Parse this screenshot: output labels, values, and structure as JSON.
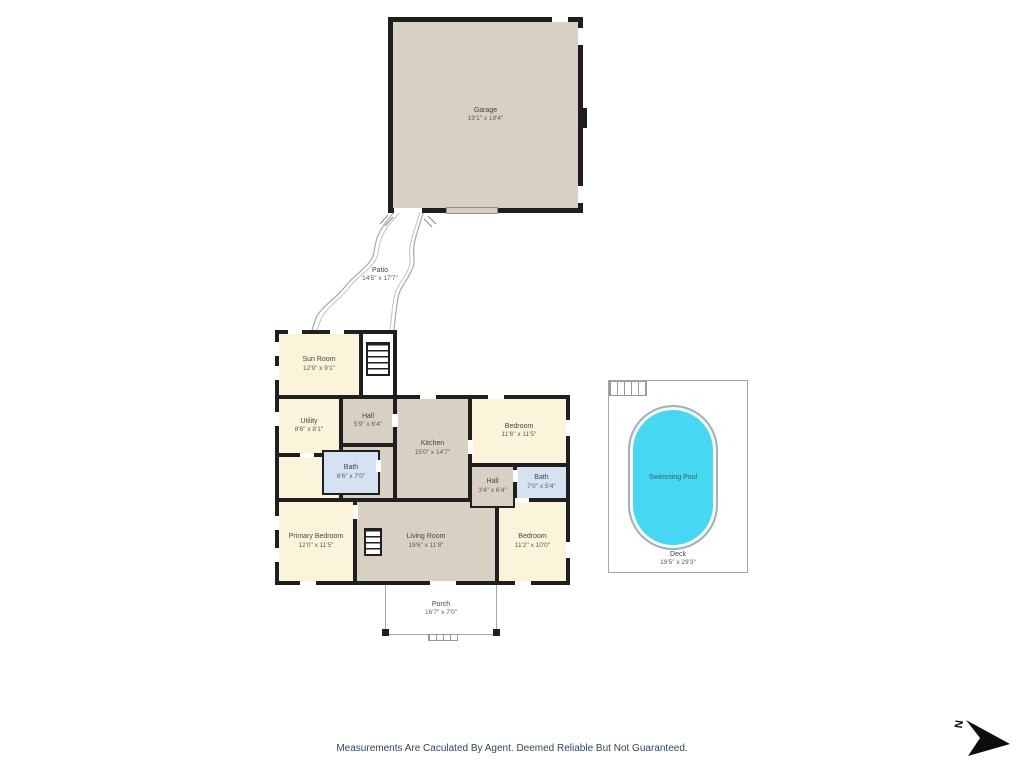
{
  "page": {
    "footer_disclaimer": "Measurements Are Caculated By Agent. Deemed Reliable But Not Guaranteed.",
    "compass_label": "N"
  },
  "colors": {
    "wall": "#1f1f1f",
    "room_tan": "#d8d0c2",
    "room_cream": "#fbf4db",
    "bath_blue": "#d4e2f2",
    "pool_water": "#46d7f2",
    "outline_gray": "#a6a6a6",
    "footer_text": "#31475a"
  },
  "rooms": {
    "garage": {
      "name": "Garage",
      "dims": "19'1\" x 19'4\""
    },
    "patio": {
      "name": "Patio",
      "dims": "14'5\" x 17'7\""
    },
    "sun_room": {
      "name": "Sun Room",
      "dims": "12'9\" x 9'1\""
    },
    "utility": {
      "name": "Utility",
      "dims": "8'6\" x 8'1\""
    },
    "hall": {
      "name": "Hall",
      "dims": "5'9\" x 6'4\""
    },
    "kitchen": {
      "name": "Kitchen",
      "dims": "15'0\" x 14'7\""
    },
    "bath_main": {
      "name": "Bath",
      "dims": "8'6\" x 7'0\""
    },
    "bedroom_ne": {
      "name": "Bedroom",
      "dims": "11'6\" x 11'5\""
    },
    "bath_small": {
      "name": "Bath",
      "dims": "7'0\" x 5'4\""
    },
    "hall_small": {
      "name": "Hall",
      "dims": "3'4\" x 6'4\""
    },
    "primary_bedroom": {
      "name": "Primary Bedroom",
      "dims": "12'0\" x 11'5\""
    },
    "living_room": {
      "name": "Living Room",
      "dims": "19'6\" x 11'8\""
    },
    "bedroom_se": {
      "name": "Bedroom",
      "dims": "11'2\" x 10'0\""
    },
    "porch": {
      "name": "Porch",
      "dims": "16'7\" x 7'0\""
    },
    "swimming_pool": {
      "name": "Swimming Pool"
    },
    "deck": {
      "name": "Deck",
      "dims": "19'5\" x 29'3\""
    }
  }
}
